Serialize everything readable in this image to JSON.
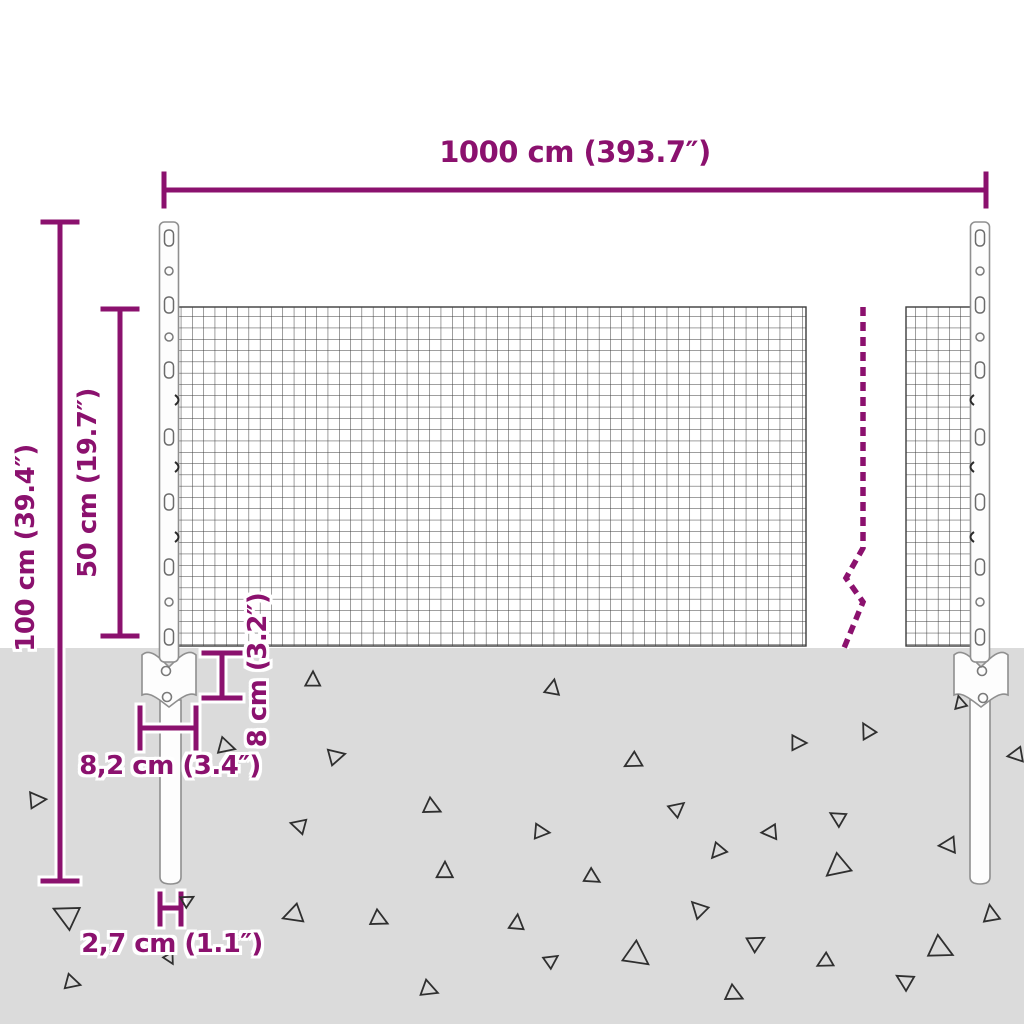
{
  "diagram": {
    "type": "product-dimension-diagram",
    "subject": "wire mesh fence panel with two anchored posts, partly buried in ground",
    "labels": {
      "total_width": "1000 cm (393.7″)",
      "total_height": "100 cm (39.4″)",
      "mesh_height": "50 cm (19.7″)",
      "anchor_depth": "8 cm (3.2″)",
      "anchor_plate_width": "8,2 cm (3.4″)",
      "post_thickness": "2,7 cm (1.1″)"
    },
    "colors": {
      "accent": "#8B116E",
      "ground": "#DBDBDB",
      "mesh_line": "#3C3C3C",
      "post_outline": "#8F8F8F",
      "gravel": "#2F2F2F"
    }
  }
}
